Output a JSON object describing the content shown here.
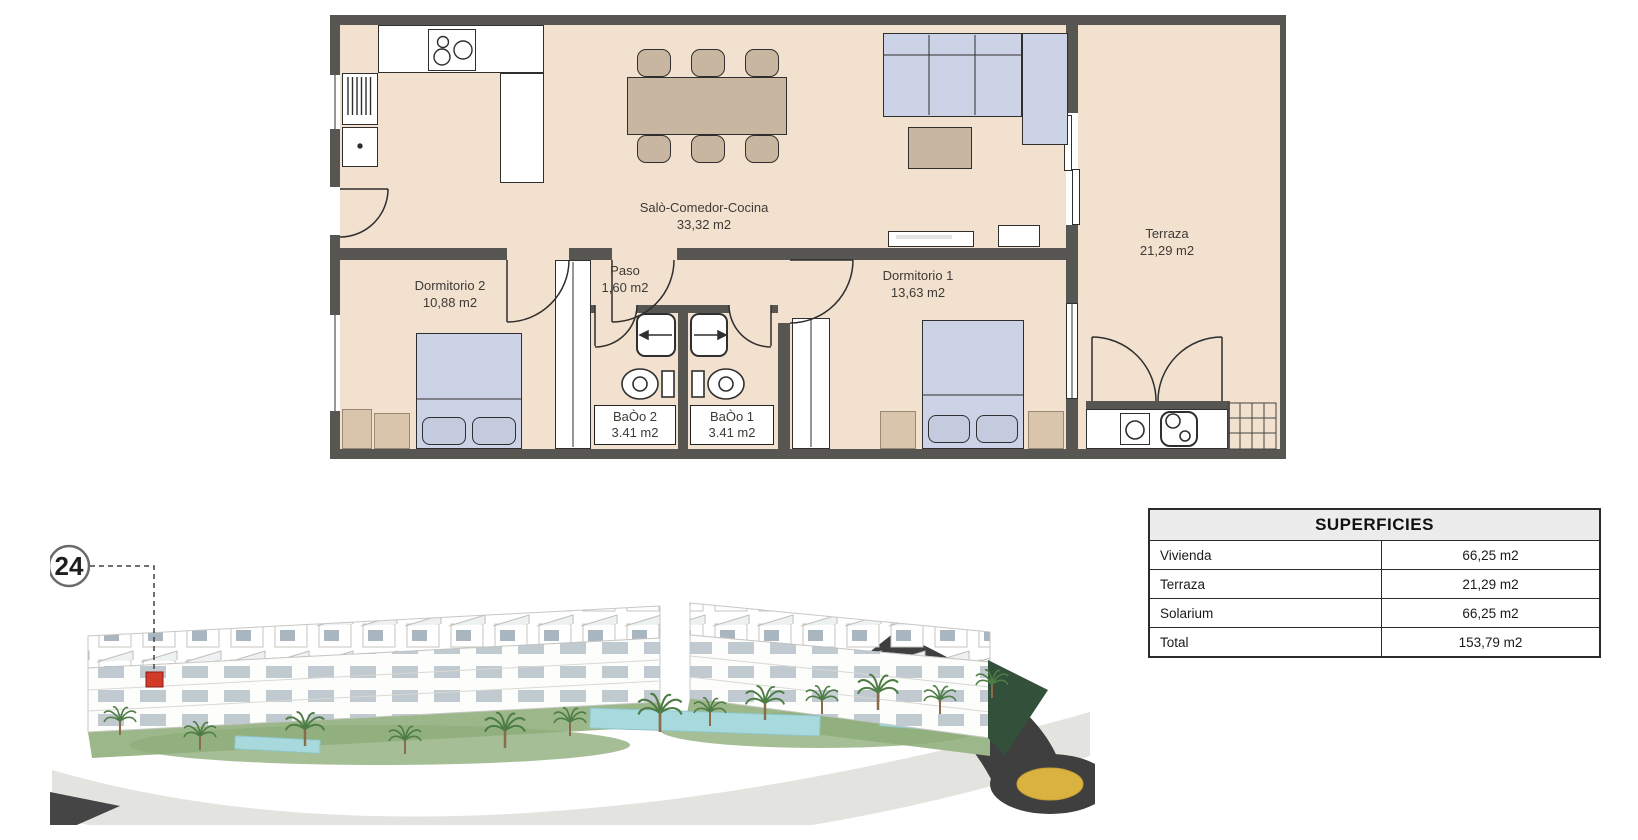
{
  "plan": {
    "rooms": {
      "living": {
        "name": "Salò-Comedor-Cocina",
        "area": "33,32 m2"
      },
      "paso": {
        "name": "Paso",
        "area": "1,60 m2"
      },
      "dormitorio2": {
        "name": "Dormitorio 2",
        "area": "10,88 m2"
      },
      "dormitorio1": {
        "name": "Dormitorio 1",
        "area": "13,63 m2"
      },
      "bano2": {
        "name": "BaÒo 2",
        "area": "3.41 m2"
      },
      "bano1": {
        "name": "BaÒo 1",
        "area": "3.41 m2"
      },
      "terraza": {
        "name": "Terraza",
        "area": "21,29 m2"
      }
    }
  },
  "marker": {
    "number": "24"
  },
  "surfaces_table": {
    "title": "SUPERFICIES",
    "rows": [
      {
        "label": "Vivienda",
        "value": "66,25 m2"
      },
      {
        "label": "Terraza",
        "value": "21,29 m2"
      },
      {
        "label": "Solarium",
        "value": "66,25 m2"
      },
      {
        "label": "Total",
        "value": "153,79 m2"
      }
    ]
  },
  "colors": {
    "floor": "#f2e1cf",
    "wall": "#575652",
    "bed_blue": "#cdd3e6",
    "wood_tan": "#c8b6a1",
    "marker_red": "#d23b2a",
    "roundabout_yellow": "#d9b23f"
  }
}
